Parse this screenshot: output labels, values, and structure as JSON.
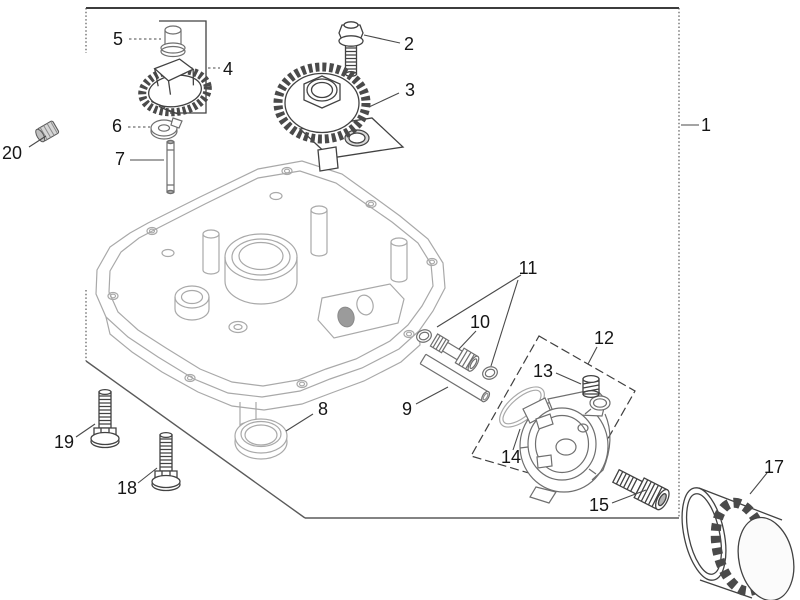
{
  "figure": {
    "kind": "exploded-parts-diagram",
    "description": "Engine oil pan and oil pump group exploded view line drawing",
    "background_color": "#ffffff",
    "primary_line_color": "#3f3f3f",
    "secondary_line_color": "#a9a9a9",
    "label_color": "#161616"
  },
  "callouts": {
    "c1": {
      "label": "1",
      "part": "group-boundary"
    },
    "c2": {
      "label": "2",
      "part": "hex-flange-bolt"
    },
    "c3": {
      "label": "3",
      "part": "gear-assembly"
    },
    "c4": {
      "label": "4",
      "part": "gear"
    },
    "c5": {
      "label": "5",
      "part": "plug"
    },
    "c6": {
      "label": "6",
      "part": "washer"
    },
    "c7": {
      "label": "7",
      "part": "shaft-pin"
    },
    "c8": {
      "label": "8",
      "part": "oil-seal"
    },
    "c9": {
      "label": "9",
      "part": "oil-tube"
    },
    "c10": {
      "label": "10",
      "part": "pickup-tube"
    },
    "c11": {
      "label": "11",
      "part": "o-ring-pair"
    },
    "c12": {
      "label": "12",
      "part": "oil-pump-assembly"
    },
    "c13": {
      "label": "13",
      "part": "relief-spring"
    },
    "c14": {
      "label": "14",
      "part": "o-ring"
    },
    "c15": {
      "label": "15",
      "part": "filter-nipple"
    },
    "c17": {
      "label": "17",
      "part": "oil-filter"
    },
    "c18": {
      "label": "18",
      "part": "hex-flange-bolt"
    },
    "c19": {
      "label": "19",
      "part": "hex-flange-bolt"
    },
    "c20": {
      "label": "20",
      "part": "plug"
    }
  }
}
